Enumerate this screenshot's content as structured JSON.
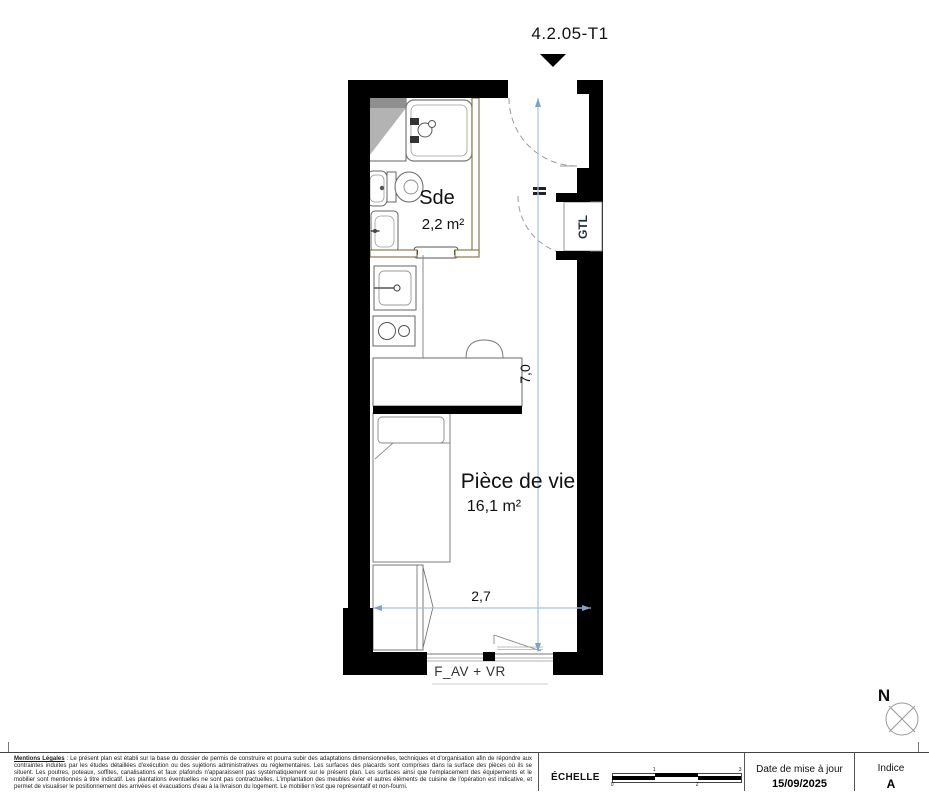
{
  "title": "4.2.05-T1",
  "rooms": {
    "sde": {
      "name": "Sde",
      "area": "2,2 m²"
    },
    "piece_de_vie": {
      "name": "Pièce de vie",
      "area": "16,1 m²"
    }
  },
  "labels": {
    "gtl": "GTL",
    "window": "F_AV + VR"
  },
  "dimensions": {
    "height": "7,0",
    "width": "2,7"
  },
  "compass": {
    "north": "N"
  },
  "footer": {
    "legal_title": "Mentions Légales",
    "legal_text": " : Le présent plan est établi sur la base du dossier de permis de construire et pourra subir des adaptations dimensionnelles, techniques et d'organisation afin de répondre aux contraintes induites par les études détaillées d'exécution ou des sujétions administratives ou réglementaires. Les surfaces des placards sont comprises dans la surface des pièces où ils se situent. Les poutres, poteaux, soffites, canalisations et faux plafonds n'apparaissent pas systématiquement sur le présent plan. Les surfaces ainsi que l'emplacement des équipements et le mobilier sont mentionnés à titre indicatif. Les plantations éventuelles ne sont pas contractuelles. L'implantation des meubles évier et autres éléments de cuisine de l'opération est indicative, et permet de visualiser le positionnement des arrivées et évacuations d'eau à la livraison du logement. Le mobilier n'est que représentatif et non-fourni.",
    "scale_label": "ÉCHELLE",
    "scale_ticks": [
      "0",
      "1",
      "2",
      "3"
    ],
    "date_label": "Date de mise à jour",
    "date_value": "15/09/2025",
    "index_label": "Indice",
    "index_value": "A"
  },
  "colors": {
    "wall": "#000000",
    "partition": "#8a7a55",
    "fixture_outline": "#777777",
    "dimension_line": "#a9c2dc",
    "gtl_text": "#1c2b4a"
  }
}
